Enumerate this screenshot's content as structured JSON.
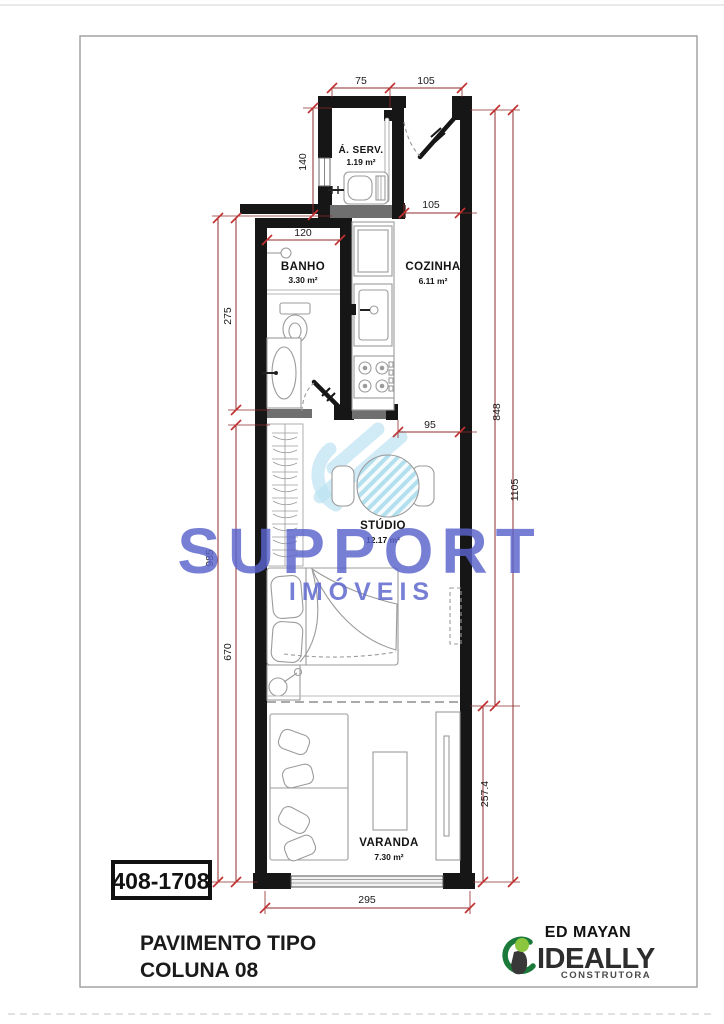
{
  "plan": {
    "rooms": [
      {
        "id": "aserv",
        "name": "Á. SERV.",
        "area": "1.19 m²"
      },
      {
        "id": "banho",
        "name": "BANHO",
        "area": "3.30 m²"
      },
      {
        "id": "cozinha",
        "name": "COZINHA",
        "area": "6.11 m²"
      },
      {
        "id": "studio",
        "name": "STÚDIO",
        "area": "12.17 m²"
      },
      {
        "id": "varanda",
        "name": "VARANDA",
        "area": "7.30 m²"
      }
    ],
    "dimensions": {
      "top_left": "75",
      "top_right": "105",
      "aserv_height": "140",
      "corridor": "105",
      "banho_width": "120",
      "banho_height": "275",
      "left_total": "985",
      "studio_height": "670",
      "right_upper": "848",
      "right_total": "1105",
      "studio_opening": "95",
      "varanda_height": "257.4",
      "bottom_width": "295"
    },
    "colors": {
      "dimension": "#8f2b2b",
      "tick": "#c23232",
      "wall": "#161616",
      "furniture": "#9b9b9b",
      "hatch": "#b3e0ee"
    }
  },
  "watermark": {
    "line1": "SUPPORT",
    "line2": "IMÓVEIS",
    "color": "#5a64cd"
  },
  "footer": {
    "unit_label": "408-1708",
    "title_line1": "PAVIMENTO TIPO",
    "title_line2": "COLUNA 08",
    "building_name": "ED MAYAN",
    "brand": {
      "name": "IDEALLY",
      "subtitle": "CONSTRUTORA",
      "green": "#1b7a3a",
      "light_green": "#8cc63f",
      "dark": "#2d2d2d"
    }
  }
}
